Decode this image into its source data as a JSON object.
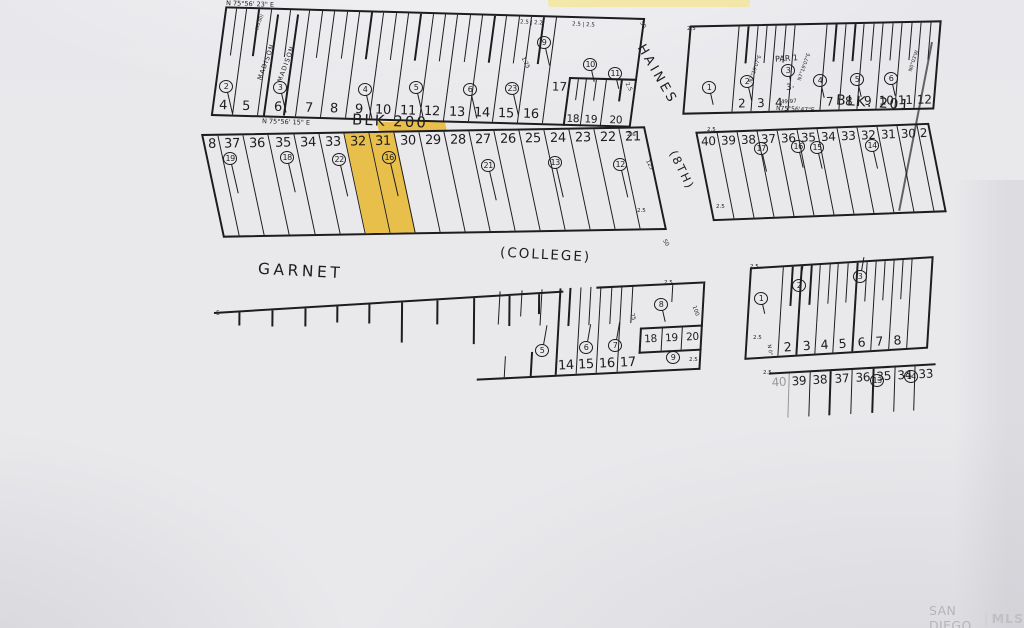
{
  "colors": {
    "paper": "#e9e9ec",
    "ink": "#1d1d20",
    "highlight": "#e7bf4a",
    "highlight_top": "#f2e7a4",
    "watermark": "#b4b4b9"
  },
  "watermark": {
    "left": "SAN DIEGO",
    "sep": "|",
    "right": "MLS"
  },
  "streets": {
    "haines": "HAINES",
    "eighth": "(8TH)",
    "garnet": "GARNET",
    "college": "(COLLEGE)"
  },
  "bearings": {
    "top": "N 75°56' 23\" E",
    "mid": "N 75°56' 15\" E",
    "blk201": "N75°56'47\"E",
    "micro_a": "N7°19'07\"E",
    "micro_b": "N7°19'07\"E",
    "micro_c": "N0°03'W",
    "south": "N 0°"
  },
  "labels": {
    "blk200": "BLK 200",
    "blk201": "BLK. 201",
    "par": "PAR 1",
    "par_note": "3·",
    "par_dim": "49.97",
    "madison_a": "MADISON",
    "madison_b": "MADISON",
    "strip_dim": "(50.00)"
  },
  "dims": {
    "pair_a": "2.5 | 2.2",
    "pair_b": "2.5 | 2.5",
    "d125s": "1.25",
    "d25": "2.5",
    "d26": "2.6",
    "d125": "125",
    "d50": "50",
    "d75": "75",
    "d100": "100",
    "d5": "5"
  },
  "blocks": {
    "b200r1": {
      "lots": [
        "4",
        "5",
        "6",
        "7",
        "8",
        "9",
        "10",
        "11",
        "12",
        "13",
        "14",
        "15",
        "16"
      ],
      "end_lot": "17",
      "sub_lots": [
        "18",
        "19",
        "20"
      ],
      "circles": [
        "2",
        "3",
        "4",
        "5",
        "6",
        "23",
        "9",
        "10",
        "11"
      ]
    },
    "b200r2": {
      "lots": [
        "8",
        "37",
        "36",
        "35",
        "34",
        "33",
        "32",
        "31",
        "30",
        "29",
        "28",
        "27",
        "26",
        "25",
        "24",
        "23",
        "22",
        "21"
      ],
      "circles": [
        "19",
        "18",
        "22",
        "16",
        "21",
        "13",
        "12"
      ]
    },
    "b201r1": {
      "lots_left": [
        "2",
        "3",
        "4"
      ],
      "lots_right": [
        "7",
        "8",
        "9",
        "10",
        "11",
        "12"
      ],
      "circles": [
        "1",
        "2",
        "3",
        "4",
        "5",
        "6"
      ]
    },
    "b201r2": {
      "lots": [
        "40",
        "39",
        "38",
        "37",
        "36",
        "35",
        "34",
        "33",
        "32",
        "31",
        "30",
        "2"
      ],
      "circles": [
        "17",
        "16",
        "15",
        "14"
      ]
    },
    "south_mid": {
      "lots": [
        "14",
        "15",
        "16",
        "17"
      ],
      "sub_lots": [
        "18",
        "19",
        "20"
      ],
      "circles": [
        "5",
        "6",
        "7",
        "8",
        "9"
      ]
    },
    "south_r1": {
      "lots": [
        "2",
        "3",
        "4",
        "5",
        "6",
        "7",
        "8"
      ],
      "circles": [
        "1",
        "2",
        "3"
      ]
    },
    "south_r2": {
      "lots": [
        "40",
        "39",
        "38",
        "37",
        "36",
        "35",
        "34",
        "33"
      ],
      "circles": [
        "13",
        "14"
      ]
    }
  }
}
